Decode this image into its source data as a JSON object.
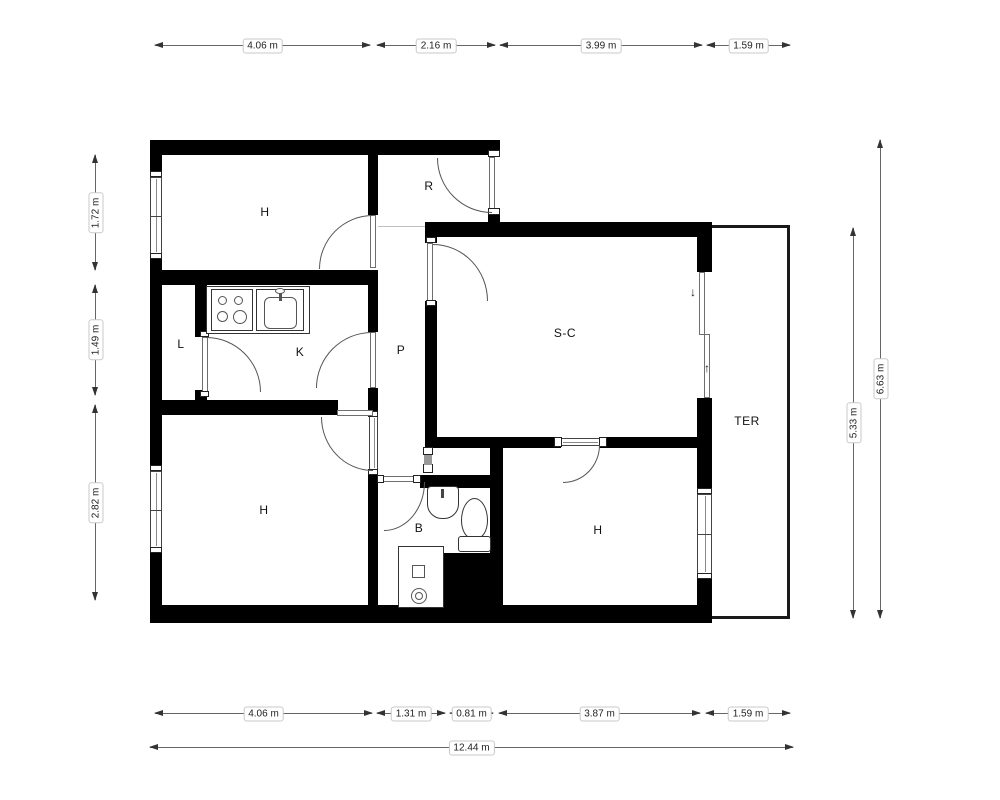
{
  "room_labels": [
    {
      "name": "h-top",
      "label": "H",
      "x": 265,
      "y": 212
    },
    {
      "name": "r",
      "label": "R",
      "x": 429,
      "y": 186
    },
    {
      "name": "l",
      "label": "L",
      "x": 181,
      "y": 344
    },
    {
      "name": "k",
      "label": "K",
      "x": 300,
      "y": 352
    },
    {
      "name": "p",
      "label": "P",
      "x": 401,
      "y": 350
    },
    {
      "name": "sc",
      "label": "S-C",
      "x": 565,
      "y": 333
    },
    {
      "name": "b",
      "label": "B",
      "x": 419,
      "y": 528
    },
    {
      "name": "h-bottom-left",
      "label": "H",
      "x": 264,
      "y": 510
    },
    {
      "name": "h-bottom-right",
      "label": "H",
      "x": 598,
      "y": 530
    },
    {
      "name": "ter",
      "label": "TER",
      "x": 747,
      "y": 421
    }
  ],
  "dimensions_horizontal": [
    {
      "label": "4.06 m",
      "x": 155,
      "y": 45,
      "w": 215
    },
    {
      "label": "2.16 m",
      "x": 377,
      "y": 45,
      "w": 118
    },
    {
      "label": "3.99 m",
      "x": 500,
      "y": 45,
      "w": 202
    },
    {
      "label": "1.59 m",
      "x": 707,
      "y": 45,
      "w": 83
    },
    {
      "label": "4.06 m",
      "x": 155,
      "y": 713,
      "w": 217
    },
    {
      "label": "1.31 m",
      "x": 377,
      "y": 713,
      "w": 68
    },
    {
      "label": "0.81 m",
      "x": 450,
      "y": 713,
      "w": 43
    },
    {
      "label": "3.87 m",
      "x": 499,
      "y": 713,
      "w": 201
    },
    {
      "label": "1.59 m",
      "x": 706,
      "y": 713,
      "w": 84
    },
    {
      "label": "12.44 m",
      "x": 150,
      "y": 747,
      "w": 643
    }
  ],
  "dimensions_vertical": [
    {
      "label": "1.72 m",
      "x": 95,
      "y": 155,
      "h": 115
    },
    {
      "label": "1.49 m",
      "x": 95,
      "y": 285,
      "h": 110
    },
    {
      "label": "2.82 m",
      "x": 95,
      "y": 405,
      "h": 195
    },
    {
      "label": "5.33 m",
      "x": 853,
      "y": 228,
      "h": 390
    },
    {
      "label": "6.63 m",
      "x": 880,
      "y": 140,
      "h": 478
    }
  ],
  "annotations": {
    "slide_down": "↓",
    "slide_up": "↑"
  }
}
